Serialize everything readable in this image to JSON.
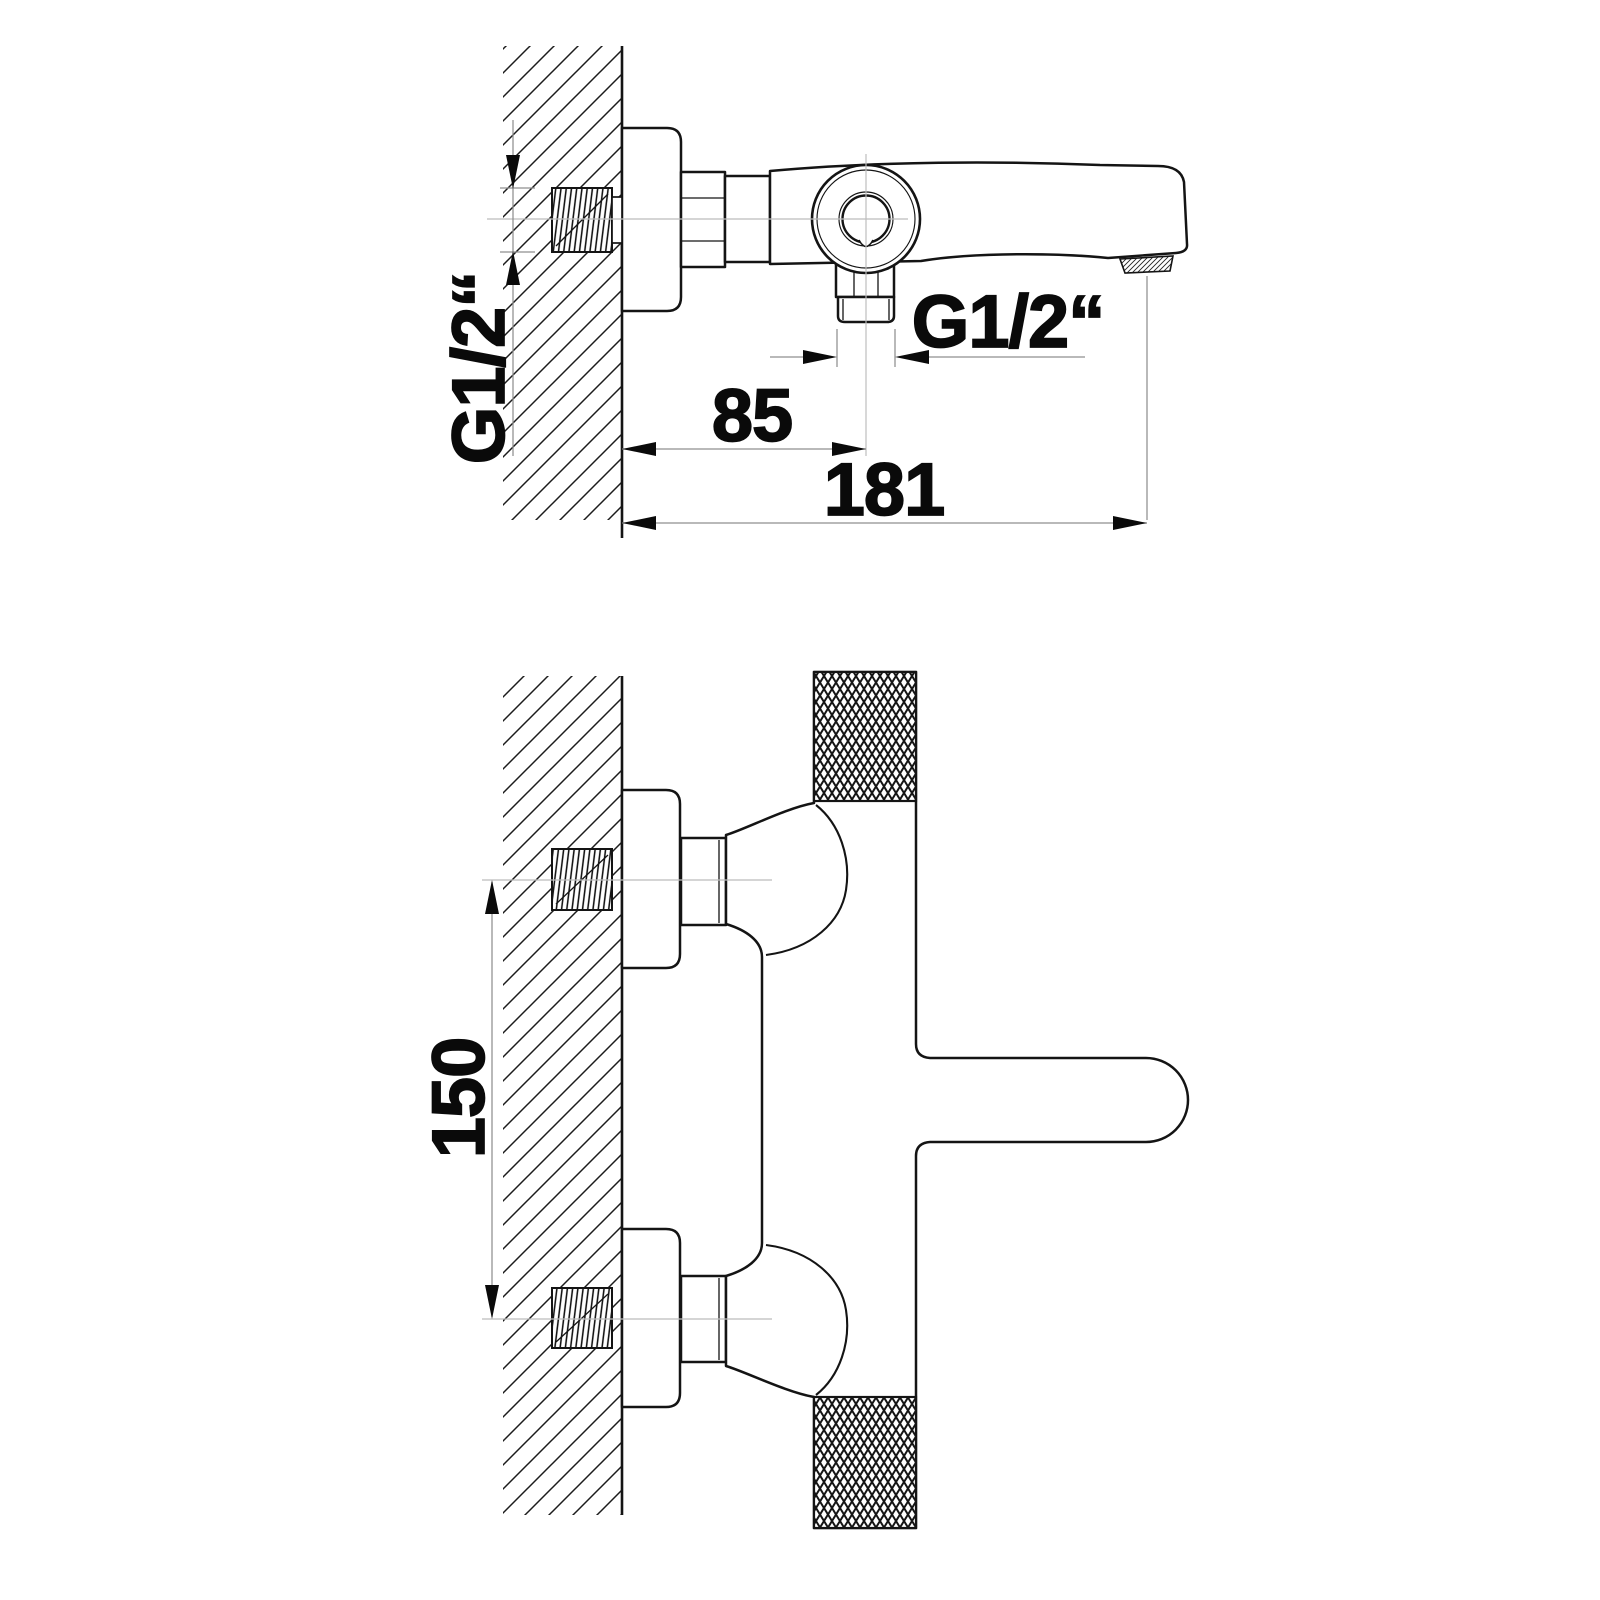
{
  "diagram": {
    "kind": "technical-dimension-drawing",
    "views": {
      "top_view": {
        "labels": {
          "inlet_thread": "G1/2“",
          "outlet_thread": "G1/2“",
          "wall_to_outlet": "85",
          "wall_to_spout_tip": "181"
        }
      },
      "front_view": {
        "labels": {
          "connection_spacing": "150"
        }
      }
    },
    "colors": {
      "line": "#141414",
      "dimension_line": "#8f8f8f",
      "centerline": "#bcbcbc",
      "text": "#0a0a0a",
      "background": "#ffffff"
    }
  }
}
